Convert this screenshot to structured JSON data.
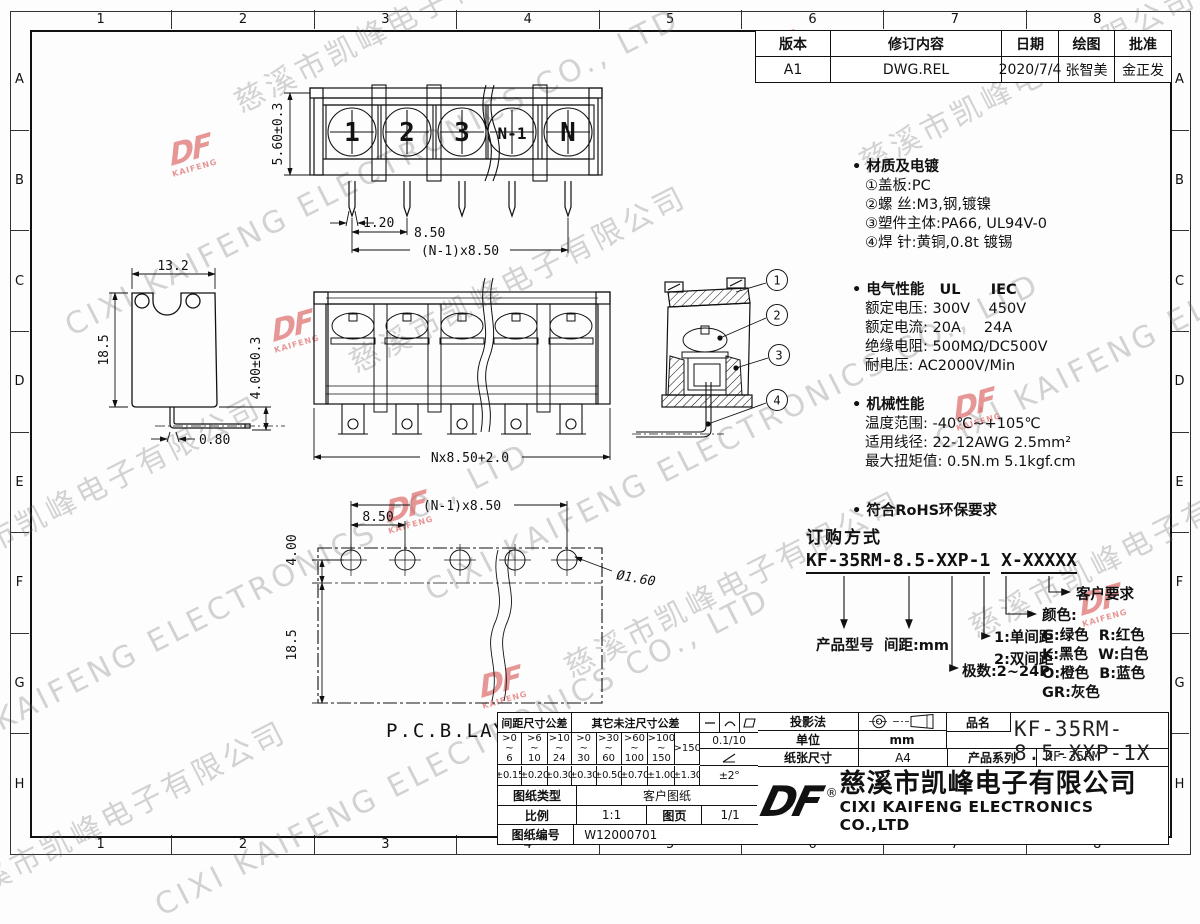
{
  "border": {
    "cols": [
      "1",
      "2",
      "3",
      "4",
      "5",
      "6",
      "7",
      "8"
    ],
    "rows": [
      "A",
      "B",
      "C",
      "D",
      "E",
      "F",
      "G",
      "H"
    ]
  },
  "watermark": {
    "cn": "慈溪市凯峰电子有限公司",
    "en": "CIXI KAIFENG ELECTRONICS CO., LTD",
    "logo_text": "DF",
    "logo_sub": "KAIFENG"
  },
  "revision_table": {
    "headers": [
      "版本",
      "修订内容",
      "日期",
      "绘图",
      "批准"
    ],
    "row": [
      "A1",
      "DWG.REL",
      "2020/7/4",
      "张智美",
      "金正发"
    ]
  },
  "views": {
    "front": {
      "screw_labels": [
        "1",
        "2",
        "3",
        "N-1",
        "N"
      ],
      "dim_height": "5.60±0.3",
      "dim_pin": "1.20",
      "dim_pitch": "8.50",
      "dim_total": "(N-1)x8.50"
    },
    "side": {
      "dim_width": "13.2",
      "dim_height": "18.5",
      "dim_pin": "0.80",
      "dim_pin_len": "4.00±0.3"
    },
    "section_front": {
      "dim_total": "Nx8.50+2.0"
    },
    "section_side": {
      "callouts": [
        "1",
        "2",
        "3",
        "4"
      ]
    },
    "pcb": {
      "label": "P.C.B.LAYOUT",
      "dim_total": "(N-1)x8.50",
      "dim_pitch": "8.50",
      "dim_edge": "4.00",
      "dim_depth": "18.5",
      "dim_hole": "Ø1.60"
    }
  },
  "specs": {
    "material": {
      "title": "• 材质及电镀",
      "items": [
        "①盖板:PC",
        "②螺 丝:M3,钢,镀镍",
        "③塑件主体:PA66, UL94V-0",
        "④焊 针:黄铜,0.8t 镀锡"
      ]
    },
    "electrical": {
      "title": "• 电气性能   UL      IEC",
      "items": [
        "额定电压: 300V    450V",
        "额定电流: 20A     24A",
        "绝缘电阻: 500MΩ/DC500V",
        "耐电压: AC2000V/Min"
      ]
    },
    "mechanical": {
      "title": "• 机械性能",
      "items": [
        "温度范围: -40℃~+105℃",
        "适用线径: 22-12AWG 2.5mm²",
        "最大扭矩值: 0.5N.m 5.1kgf.cm"
      ]
    },
    "rohs": "• 符合RoHS环保要求"
  },
  "ordering": {
    "title": "订购方式",
    "code_segments": [
      "KF-35RM",
      "-",
      "8.5",
      "-",
      "XXP",
      "-",
      "1",
      " ",
      "X",
      "-",
      "XXXXX"
    ],
    "labels": {
      "model": "产品型号",
      "pitch": "间距:mm",
      "poles": "极数:2~24P",
      "row1": "1:单间距",
      "row2": "2:双间距",
      "color_title": "颜色:",
      "colors": [
        "G:绿色  R:红色",
        "K:黑色  W:白色",
        "O:橙色  B:蓝色",
        "GR:灰色"
      ],
      "customer": "客户要求"
    }
  },
  "tolerance_table": {
    "pitch_header": "间距尺寸公差",
    "other_header": "其它未注尺寸公差",
    "ranges": [
      ">0\n~\n6",
      ">6\n~\n10",
      ">10\n~\n24",
      ">0\n~\n30",
      ">30\n~\n60",
      ">60\n~\n100",
      ">100\n~\n150",
      ">150"
    ],
    "values": [
      "±0.15",
      "±0.20",
      "±0.30",
      "±0.30",
      "±0.50",
      "±0.70",
      "±1.00",
      "±1.30"
    ],
    "flatness_value": "0.1/10",
    "angle_value": "±2°"
  },
  "title_block": {
    "projection_label": "投影法",
    "unit_label": "单位",
    "unit_value": "mm",
    "paper_label": "纸张尺寸",
    "paper_value": "A4",
    "part_label": "品名",
    "part_value": "KF-35RM-8.5-XXP-1X",
    "series_label": "产品系列",
    "series_value": "KF-35RM",
    "type_label": "图纸类型",
    "type_value": "客户图纸",
    "scale_label": "比例",
    "scale_value": "1:1",
    "page_label": "图页",
    "page_value": "1/1",
    "number_label": "图纸编号",
    "number_value": "W12000701",
    "registered": "®",
    "company_cn": "慈溪市凯峰电子有限公司",
    "company_en": "CIXI KAIFENG ELECTRONICS CO.,LTD"
  }
}
